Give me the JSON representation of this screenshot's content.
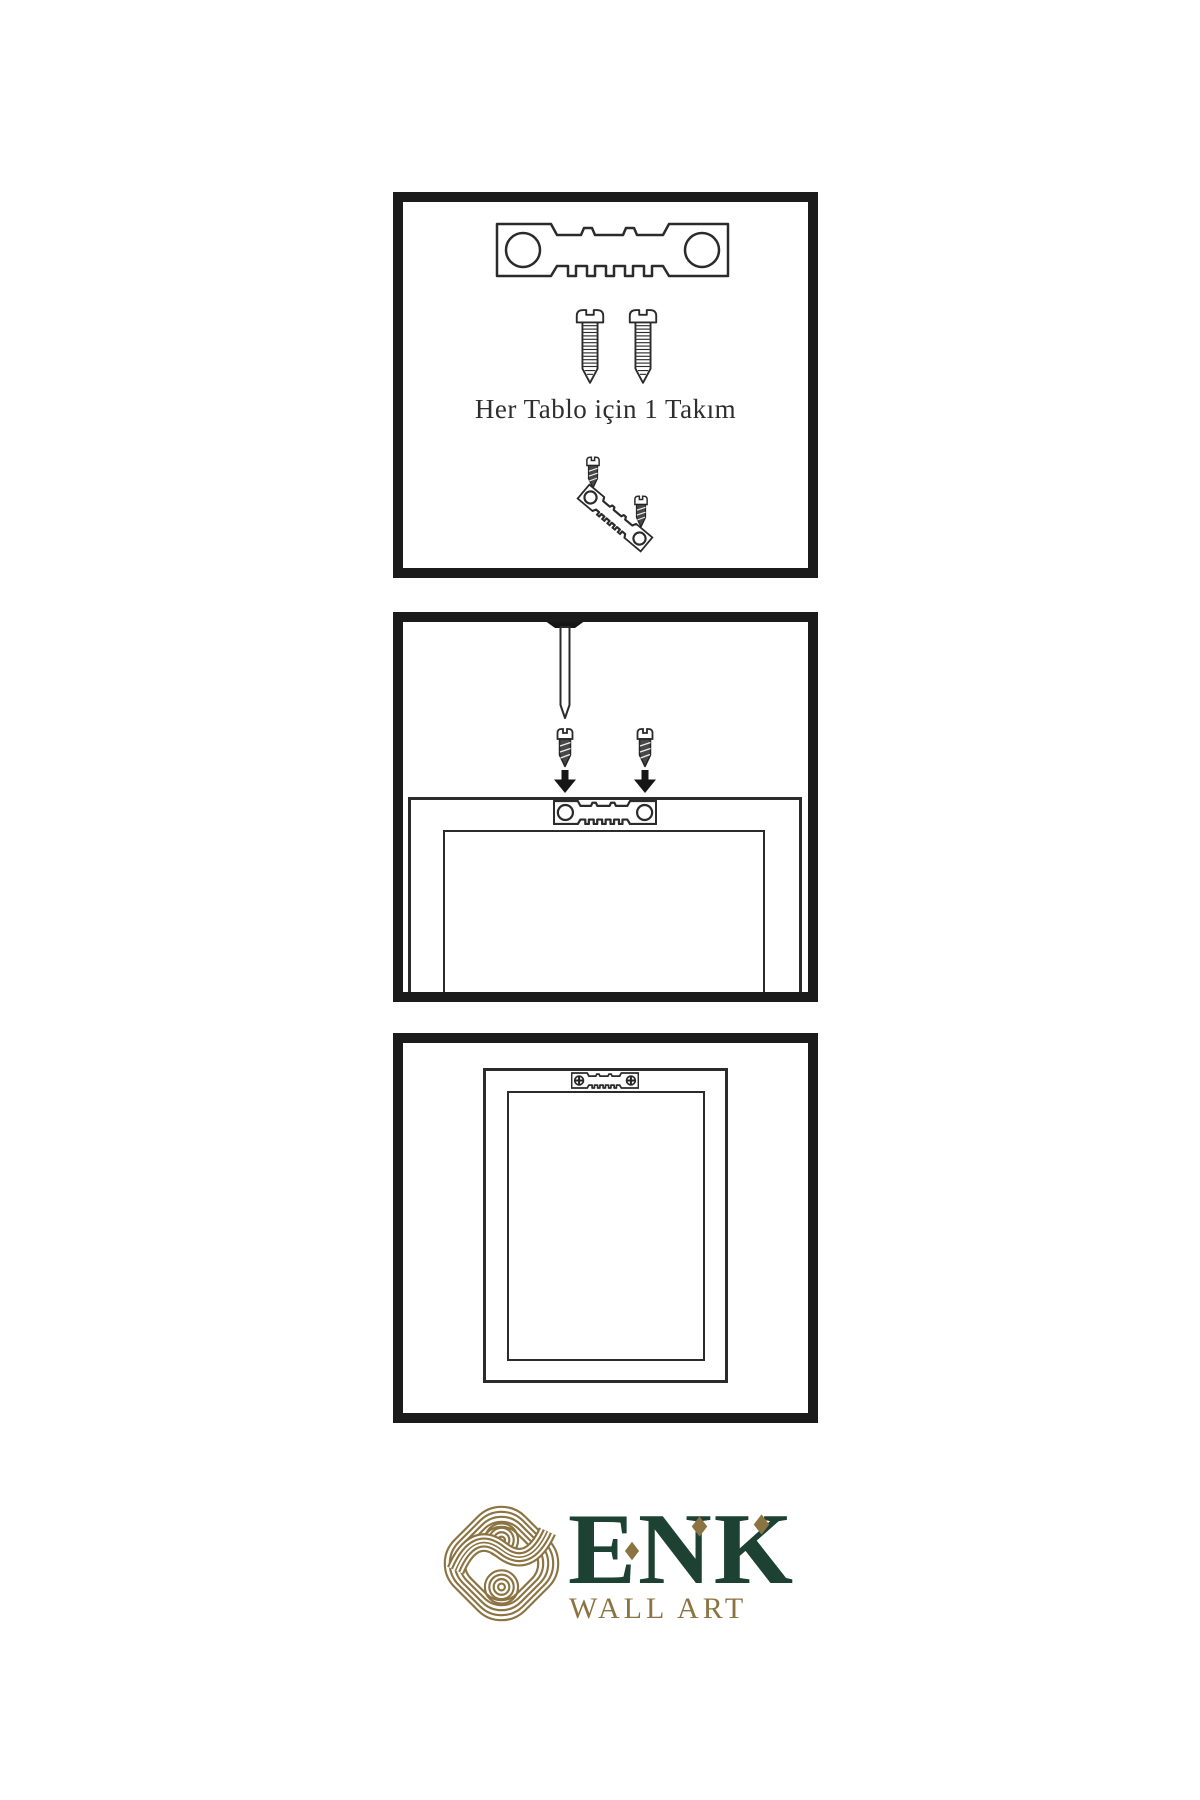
{
  "background": "#ffffff",
  "colors": {
    "panel_border": "#1b1b1b",
    "line_art": "#2b2b2b",
    "screw_dark_fill": "#474747",
    "logo_gold": "#8b7442",
    "logo_green": "#1d4133"
  },
  "step1": {
    "caption": "Her Tablo için 1 Takım"
  },
  "logo": {
    "name": "ENK",
    "subtitle": "WALL ART"
  },
  "icons": {
    "hanger": "sawtooth-hanger-icon",
    "screw": "screw-icon",
    "screw_dark": "screw-dark-icon",
    "nail": "nail-icon",
    "arrow": "arrow-down-icon",
    "frame_back": "frame-back-outline",
    "frame_front": "frame-front-outline",
    "knot": "knot-logo-icon",
    "diamond": "logo-diamond-accent"
  }
}
